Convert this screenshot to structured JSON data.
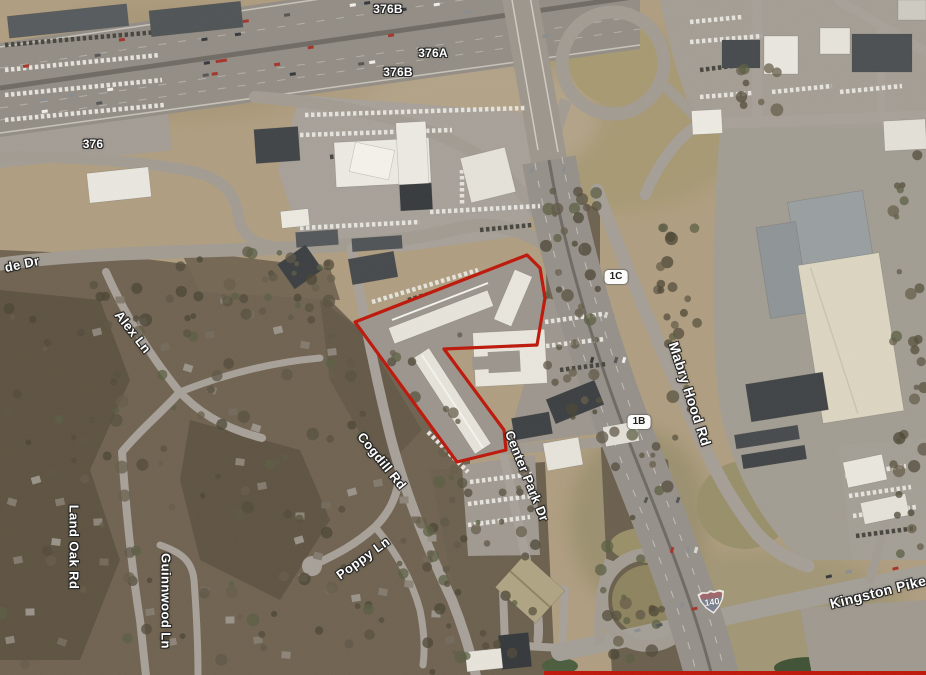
{
  "labels": {
    "exit_376b_north": "376B",
    "exit_376a": "376A",
    "exit_376b_south": "376B",
    "route_376": "376",
    "parkside_dr_clipped": "de Dr",
    "alex_ln": "Alex Ln",
    "land_oak_rd": "Land Oak Rd",
    "guinnwood_ln": "Guinnwood Ln",
    "poppy_ln": "Poppy Ln",
    "cogdill_rd": "Cogdill Rd",
    "center_park_dr": "Center Park Dr",
    "mabry_hood_rd": "Mabry Hood Rd",
    "kingston_pike": "Kingston Pike",
    "exit_1c": "1C",
    "exit_1b": "1B",
    "interstate_140": "140"
  },
  "colors": {
    "parcel_outline": "#bf1508",
    "border_strip": "#c01508",
    "terrain_tan": "#b19f81",
    "woods_dark": "#665a48",
    "road_gray": "#96918a",
    "building_white": "#eceae2",
    "label_text": "#ffffff"
  }
}
